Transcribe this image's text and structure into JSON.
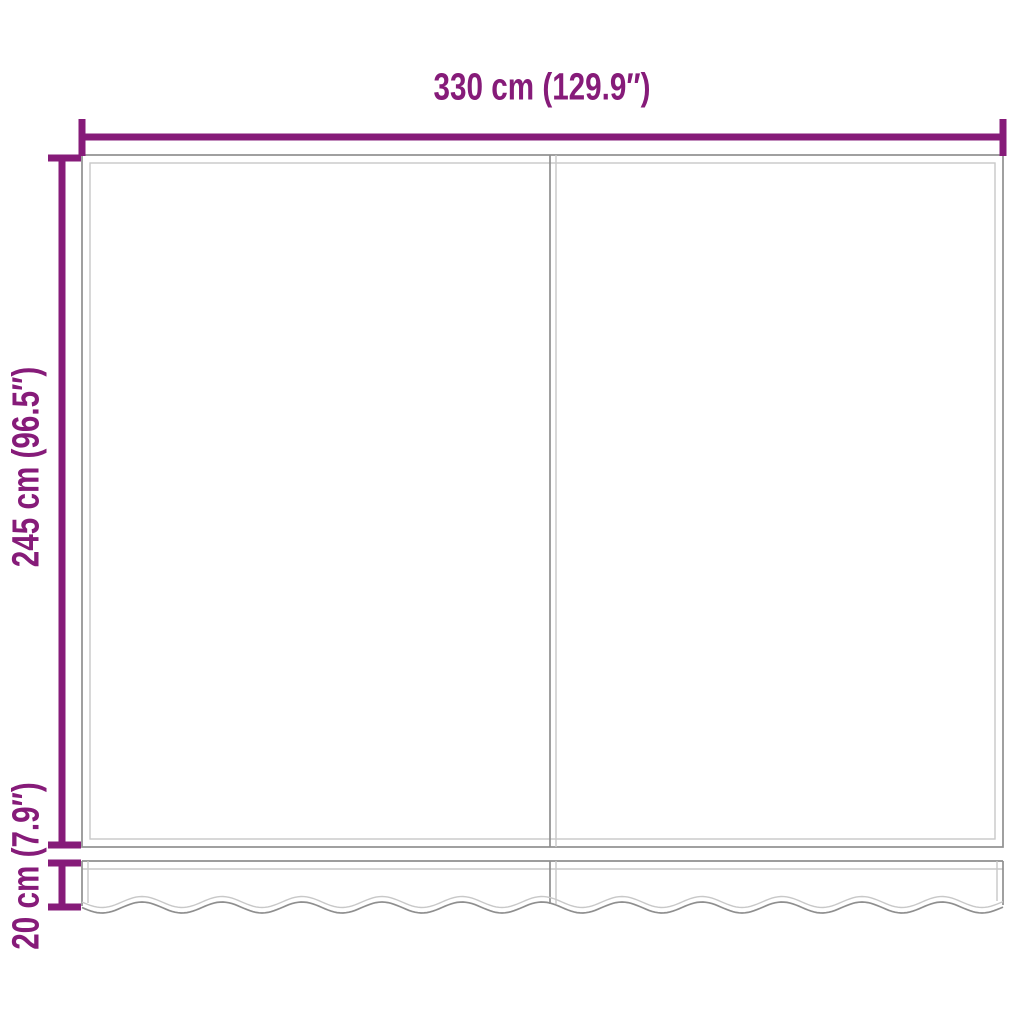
{
  "labels": {
    "width": "330 cm (129.9″)",
    "height": "245 cm (96.5″)",
    "valance_height": "20 cm (7.9″)"
  },
  "colors": {
    "dimension": "#861b79",
    "outline_dark": "#8f8f8f",
    "outline_light": "#c8c8c8",
    "background": "#ffffff"
  }
}
